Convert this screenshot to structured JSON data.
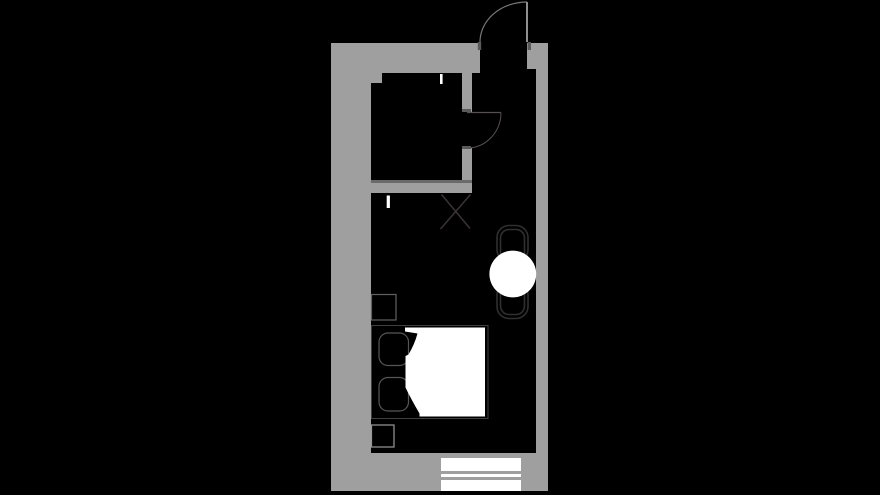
{
  "scene": {
    "type": "floor-plan",
    "description": "Hotel guest room floor plan, white/gray line drawing on black background"
  },
  "colors": {
    "background": "#000000",
    "wall": "#9f9f9f",
    "wall_edge": "#6a6a6a",
    "door_jamb": "#5a5a5a",
    "entry_door_leaf": "#8f8f8f",
    "entry_door_arc": "#787878",
    "bath_door_line": "#565050",
    "luggage_rack_line": "#3a3434",
    "bed_frame_line": "#3f3f3f",
    "pillow_line": "#565656",
    "nightstand_line": "#606060",
    "stool_line": "#999999",
    "chair_line": "#2f2f2f",
    "white_fill": "#ffffff"
  },
  "elements": {
    "rooms": [
      "bathroom",
      "entry-corridor",
      "bedroom"
    ],
    "doors": [
      "entry-door-outward-swing",
      "bathroom-door-inward-swing"
    ],
    "window": "triple-pane-window-bottom-wall",
    "furniture": [
      "double-bed",
      "pillow",
      "pillow",
      "duvet",
      "nightstand",
      "stool",
      "round-table",
      "chair",
      "chair",
      "luggage-rack"
    ],
    "markers": [
      "bathroom-wall-tick",
      "bedroom-wall-tick"
    ]
  }
}
